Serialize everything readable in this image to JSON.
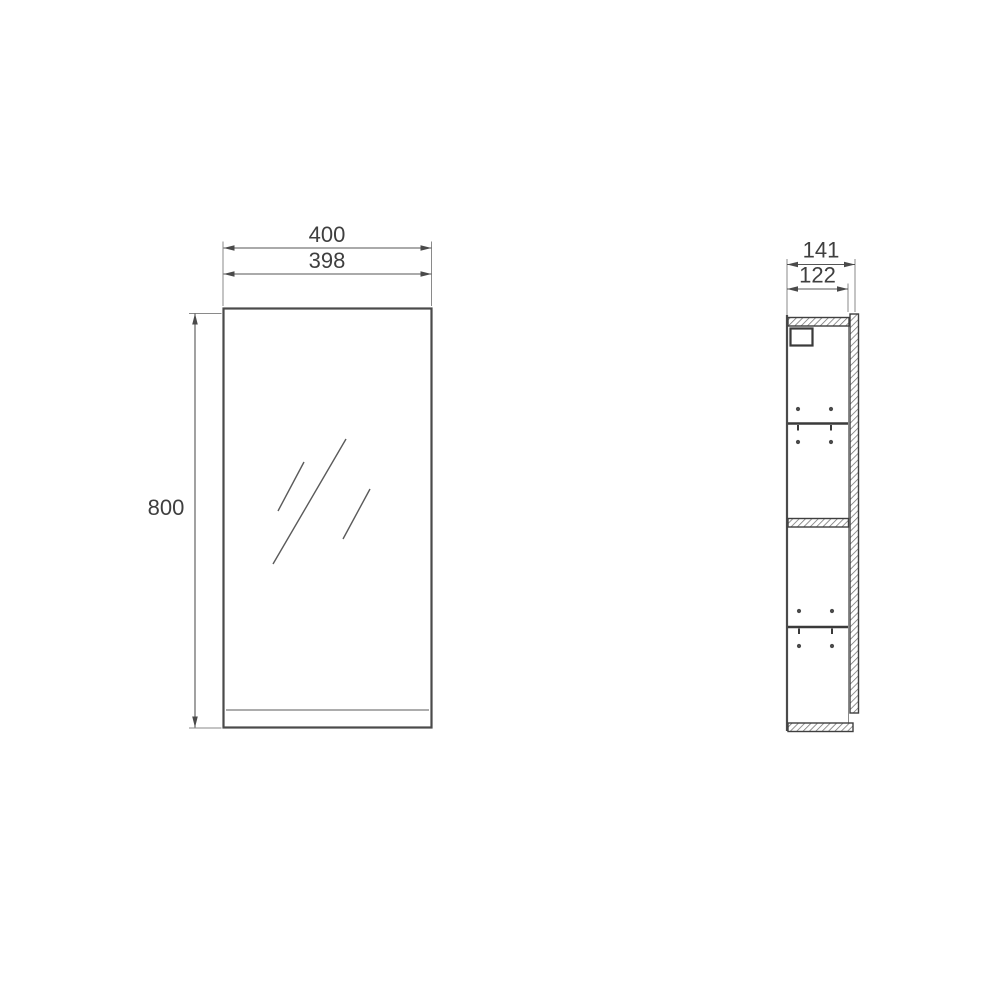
{
  "diagram": {
    "type": "technical-drawing",
    "subject": "wall-hung mirror cabinet, front view and side section view",
    "front_view": {
      "dim_width_outer": "400",
      "dim_width_inner": "398",
      "dim_height": "800"
    },
    "side_view": {
      "dim_depth_outer": "141",
      "dim_depth_inner": "122"
    },
    "colors": {
      "background": "#ffffff",
      "outline": "#4a4a4a",
      "dimension_line": "#555555",
      "extension_line": "#8a8a8a",
      "text": "#3f3f3f",
      "hatch": "#6f6f6f"
    }
  }
}
